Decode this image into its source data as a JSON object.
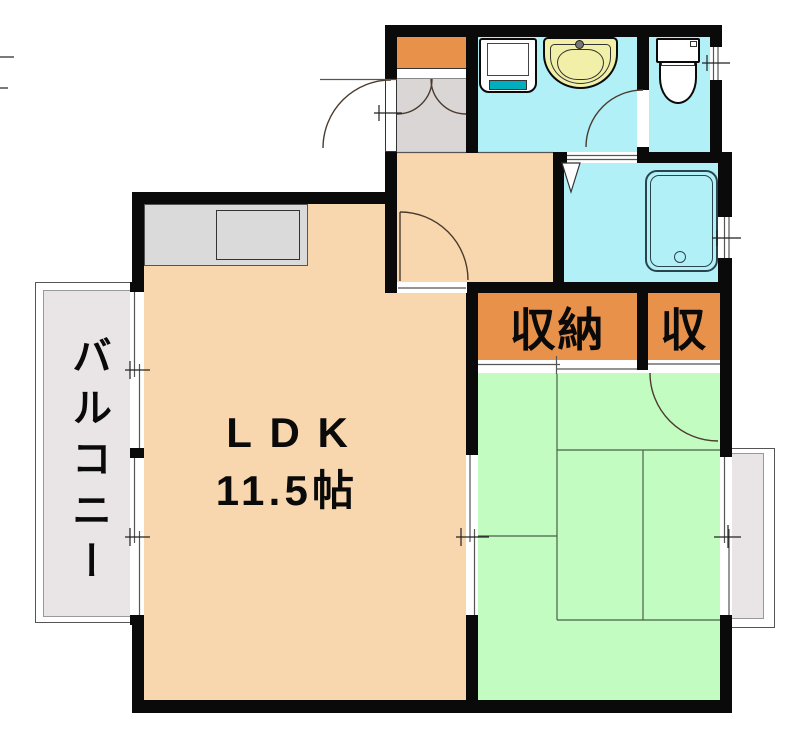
{
  "labels": {
    "ldk": "LDK",
    "ldk_size": "11.5帖",
    "closet_main": "収納",
    "closet_small": "収",
    "balcony": "バルコニー"
  },
  "colors": {
    "wall": "#0a0a0a",
    "wood_floor": "#F8D7AF",
    "tatami_green": "#C3FCC1",
    "wet_area_cyan": "#B2F0F8",
    "closet_orange": "#E8914B",
    "entry_gray": "#DBD6D6",
    "balcony_gray": "#E9E4E5",
    "kitchen_counter_gray": "#DADADA",
    "washbasin_yellow": "#F2F0A8",
    "washer_pan_teal": "#00AEBE"
  }
}
